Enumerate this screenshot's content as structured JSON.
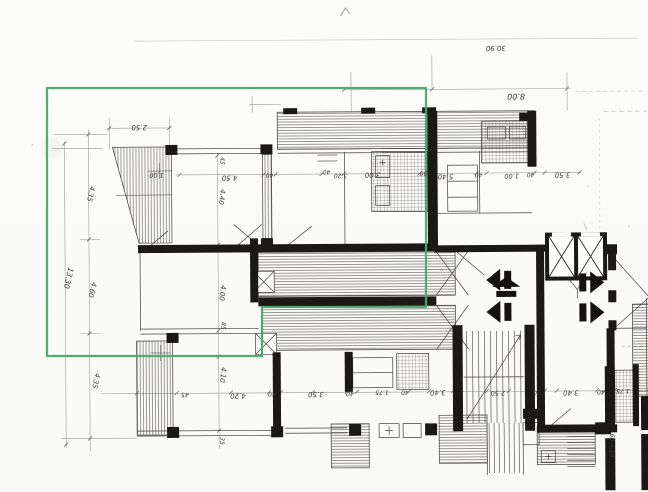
{
  "plan": {
    "description": "scanned architectural floor plan with green highlight outline",
    "paper_color": "#fbfbf8",
    "ink_color": "#1b1916",
    "faint_ink": "#a8a59d",
    "highlight_color": "#4aa96c"
  },
  "overall_dimensions": {
    "top_total": "30.90",
    "top_wing": "8.00",
    "left_total": "13.30"
  },
  "dimension_labels": [
    {
      "text": "30.90",
      "x": 497,
      "y": 47,
      "rot": 180,
      "size": 7,
      "faint": true
    },
    {
      "text": "8.00",
      "x": 517,
      "y": 95,
      "rot": 180,
      "size": 8,
      "faint": false
    },
    {
      "text": "2.50",
      "x": 140,
      "y": 124,
      "rot": 180,
      "size": 7,
      "faint": false
    },
    {
      "text": "1.00",
      "x": 157,
      "y": 172,
      "rot": 180,
      "size": 6.5,
      "faint": false
    },
    {
      "text": "45",
      "x": 221,
      "y": 160,
      "rot": 97,
      "size": 6,
      "faint": false
    },
    {
      "text": "4.50",
      "x": 230,
      "y": 175,
      "rot": 180,
      "size": 7,
      "faint": false
    },
    {
      "text": "40",
      "x": 270,
      "y": 173,
      "rot": 180,
      "size": 6,
      "faint": false
    },
    {
      "text": "4.40",
      "x": 220,
      "y": 196,
      "rot": 97,
      "size": 7,
      "faint": false
    },
    {
      "text": "40",
      "x": 327,
      "y": 170,
      "rot": 180,
      "size": 6,
      "faint": false
    },
    {
      "text": "3.20",
      "x": 341,
      "y": 174,
      "rot": 180,
      "size": 6,
      "faint": false
    },
    {
      "text": "3.00",
      "x": 373,
      "y": 173,
      "rot": 180,
      "size": 7,
      "faint": false
    },
    {
      "text": "80",
      "x": 424,
      "y": 172,
      "rot": 180,
      "size": 6,
      "faint": false
    },
    {
      "text": "5.40",
      "x": 446,
      "y": 175,
      "rot": 180,
      "size": 7,
      "faint": false
    },
    {
      "text": "40",
      "x": 479,
      "y": 174,
      "rot": 180,
      "size": 6,
      "faint": false
    },
    {
      "text": "1.00",
      "x": 512,
      "y": 175,
      "rot": 180,
      "size": 6.5,
      "faint": false
    },
    {
      "text": "40",
      "x": 531,
      "y": 174,
      "rot": 180,
      "size": 6,
      "faint": false
    },
    {
      "text": "3.50",
      "x": 563,
      "y": 174,
      "rot": 180,
      "size": 7,
      "faint": false
    },
    {
      "text": "13.30",
      "x": 66,
      "y": 276,
      "rot": 103,
      "size": 7.5,
      "faint": false
    },
    {
      "text": "4.35",
      "x": 89,
      "y": 192,
      "rot": 103,
      "size": 7,
      "faint": false
    },
    {
      "text": "4.60",
      "x": 90,
      "y": 288,
      "rot": 103,
      "size": 7,
      "faint": false
    },
    {
      "text": "4.35",
      "x": 93,
      "y": 379,
      "rot": 103,
      "size": 7,
      "faint": false
    },
    {
      "text": "4.00",
      "x": 220,
      "y": 292,
      "rot": 97,
      "size": 7,
      "faint": false
    },
    {
      "text": "85",
      "x": 221,
      "y": 325,
      "rot": 97,
      "size": 6,
      "faint": false
    },
    {
      "text": "4.10",
      "x": 220,
      "y": 374,
      "rot": 97,
      "size": 7,
      "faint": false
    },
    {
      "text": "35",
      "x": 219,
      "y": 440,
      "rot": 97,
      "size": 6,
      "faint": false
    },
    {
      "text": "45",
      "x": 184,
      "y": 392,
      "rot": 180,
      "size": 6,
      "faint": false
    },
    {
      "text": "4.20",
      "x": 237,
      "y": 393,
      "rot": 180,
      "size": 7,
      "faint": false
    },
    {
      "text": "40",
      "x": 271,
      "y": 392,
      "rot": 180,
      "size": 6,
      "faint": false
    },
    {
      "text": "3.50",
      "x": 315,
      "y": 392,
      "rot": 180,
      "size": 7,
      "faint": false
    },
    {
      "text": "40",
      "x": 349,
      "y": 392,
      "rot": 180,
      "size": 6,
      "faint": false
    },
    {
      "text": "1.75",
      "x": 381,
      "y": 391,
      "rot": 180,
      "size": 6,
      "faint": false
    },
    {
      "text": "40",
      "x": 404,
      "y": 391,
      "rot": 180,
      "size": 6,
      "faint": false
    },
    {
      "text": "3.40",
      "x": 437,
      "y": 391,
      "rot": 180,
      "size": 7,
      "faint": false
    },
    {
      "text": "2.50",
      "x": 497,
      "y": 392,
      "rot": 180,
      "size": 6.5,
      "faint": false
    },
    {
      "text": "20",
      "x": 536,
      "y": 392,
      "rot": 180,
      "size": 6,
      "faint": false
    },
    {
      "text": "3.40",
      "x": 570,
      "y": 392,
      "rot": 180,
      "size": 7,
      "faint": false
    },
    {
      "text": "40",
      "x": 600,
      "y": 392,
      "rot": 180,
      "size": 6,
      "faint": false
    },
    {
      "text": "1.75",
      "x": 622,
      "y": 391,
      "rot": 180,
      "size": 6,
      "faint": false
    },
    {
      "text": "60",
      "x": 609,
      "y": 439,
      "rot": 97,
      "size": 6,
      "faint": false
    },
    {
      "text": "1.10",
      "x": 609,
      "y": 452,
      "rot": 97,
      "size": 6,
      "faint": false
    }
  ]
}
